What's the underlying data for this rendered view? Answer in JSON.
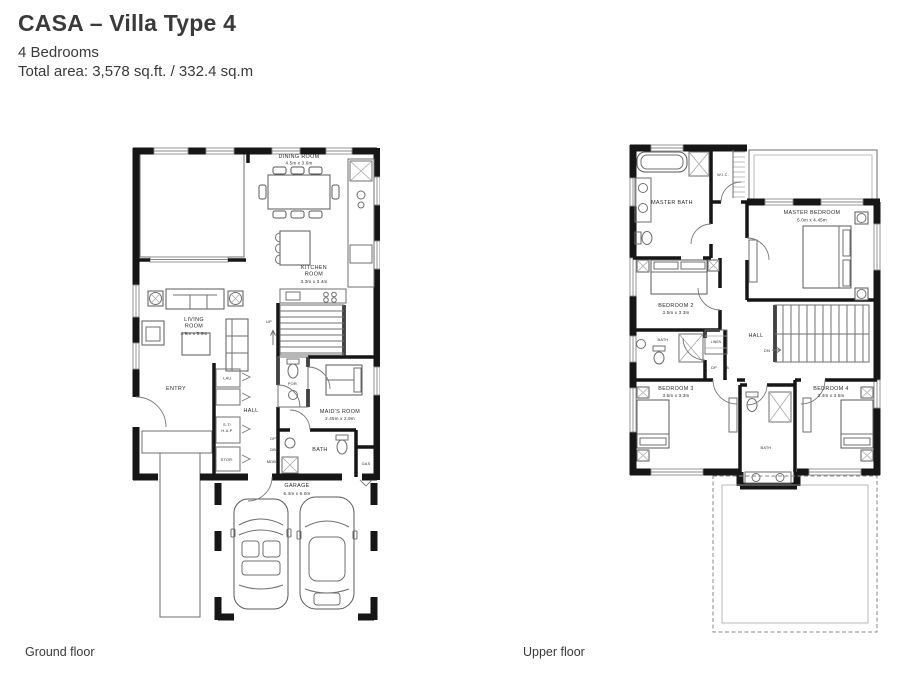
{
  "header": {
    "title": "CASA – Villa Type 4",
    "bedrooms": "4 Bedrooms",
    "total_area": "Total area: 3,578 sq.ft. / 332.4 sq.m"
  },
  "ground_floor": {
    "caption": "Ground floor",
    "labels": {
      "dining_name": "DINING ROOM",
      "dining_dims": "4.5m x 3.6m",
      "kitchen_name1": "KITCHEN",
      "kitchen_name2": "ROOM",
      "kitchen_dims": "3.3m x 3.4m",
      "living_name1": "LIVING",
      "living_name2": "ROOM",
      "living_dims": "4.9m x 5.9m",
      "entry": "ENTRY",
      "laundry": "LAU.",
      "hall": "HALL",
      "st_hap_line1": "S.T/",
      "st_hap_line2": "H.A.P",
      "storage": "STOR.",
      "powder": "POR.",
      "maids_name": "MAID'S ROOM",
      "maids_dims": "2.45m x 2.9m",
      "bath": "BATH",
      "gas": "GAS",
      "garage_name": "GARAGE",
      "garage_dims": "6.4m x 6.0m",
      "up": "UP",
      "dp": "DP",
      "db": "DB",
      "mdb": "MDB"
    }
  },
  "upper_floor": {
    "caption": "Upper floor",
    "labels": {
      "master_bath": "MASTER BATH",
      "wic": "W.I.C.",
      "master_bedroom_name": "MASTER BEDROOM",
      "master_bedroom_dims": "5.0m x 4.45m",
      "bedroom2_name": "BEDROOM 2",
      "bedroom2_dims": "3.5m x 3.3m",
      "bath2": "BATH",
      "linen": "LINEN",
      "hall": "HALL",
      "dn": "DN",
      "dp": "DP",
      "db": "DB",
      "bedroom3_name": "BEDROOM 3",
      "bedroom3_dims": "3.6m x 3.3m",
      "bedroom4_name": "BEDROOM 4",
      "bedroom4_dims": "3.4m x 3.5m",
      "bath_shared": "BATH"
    }
  }
}
